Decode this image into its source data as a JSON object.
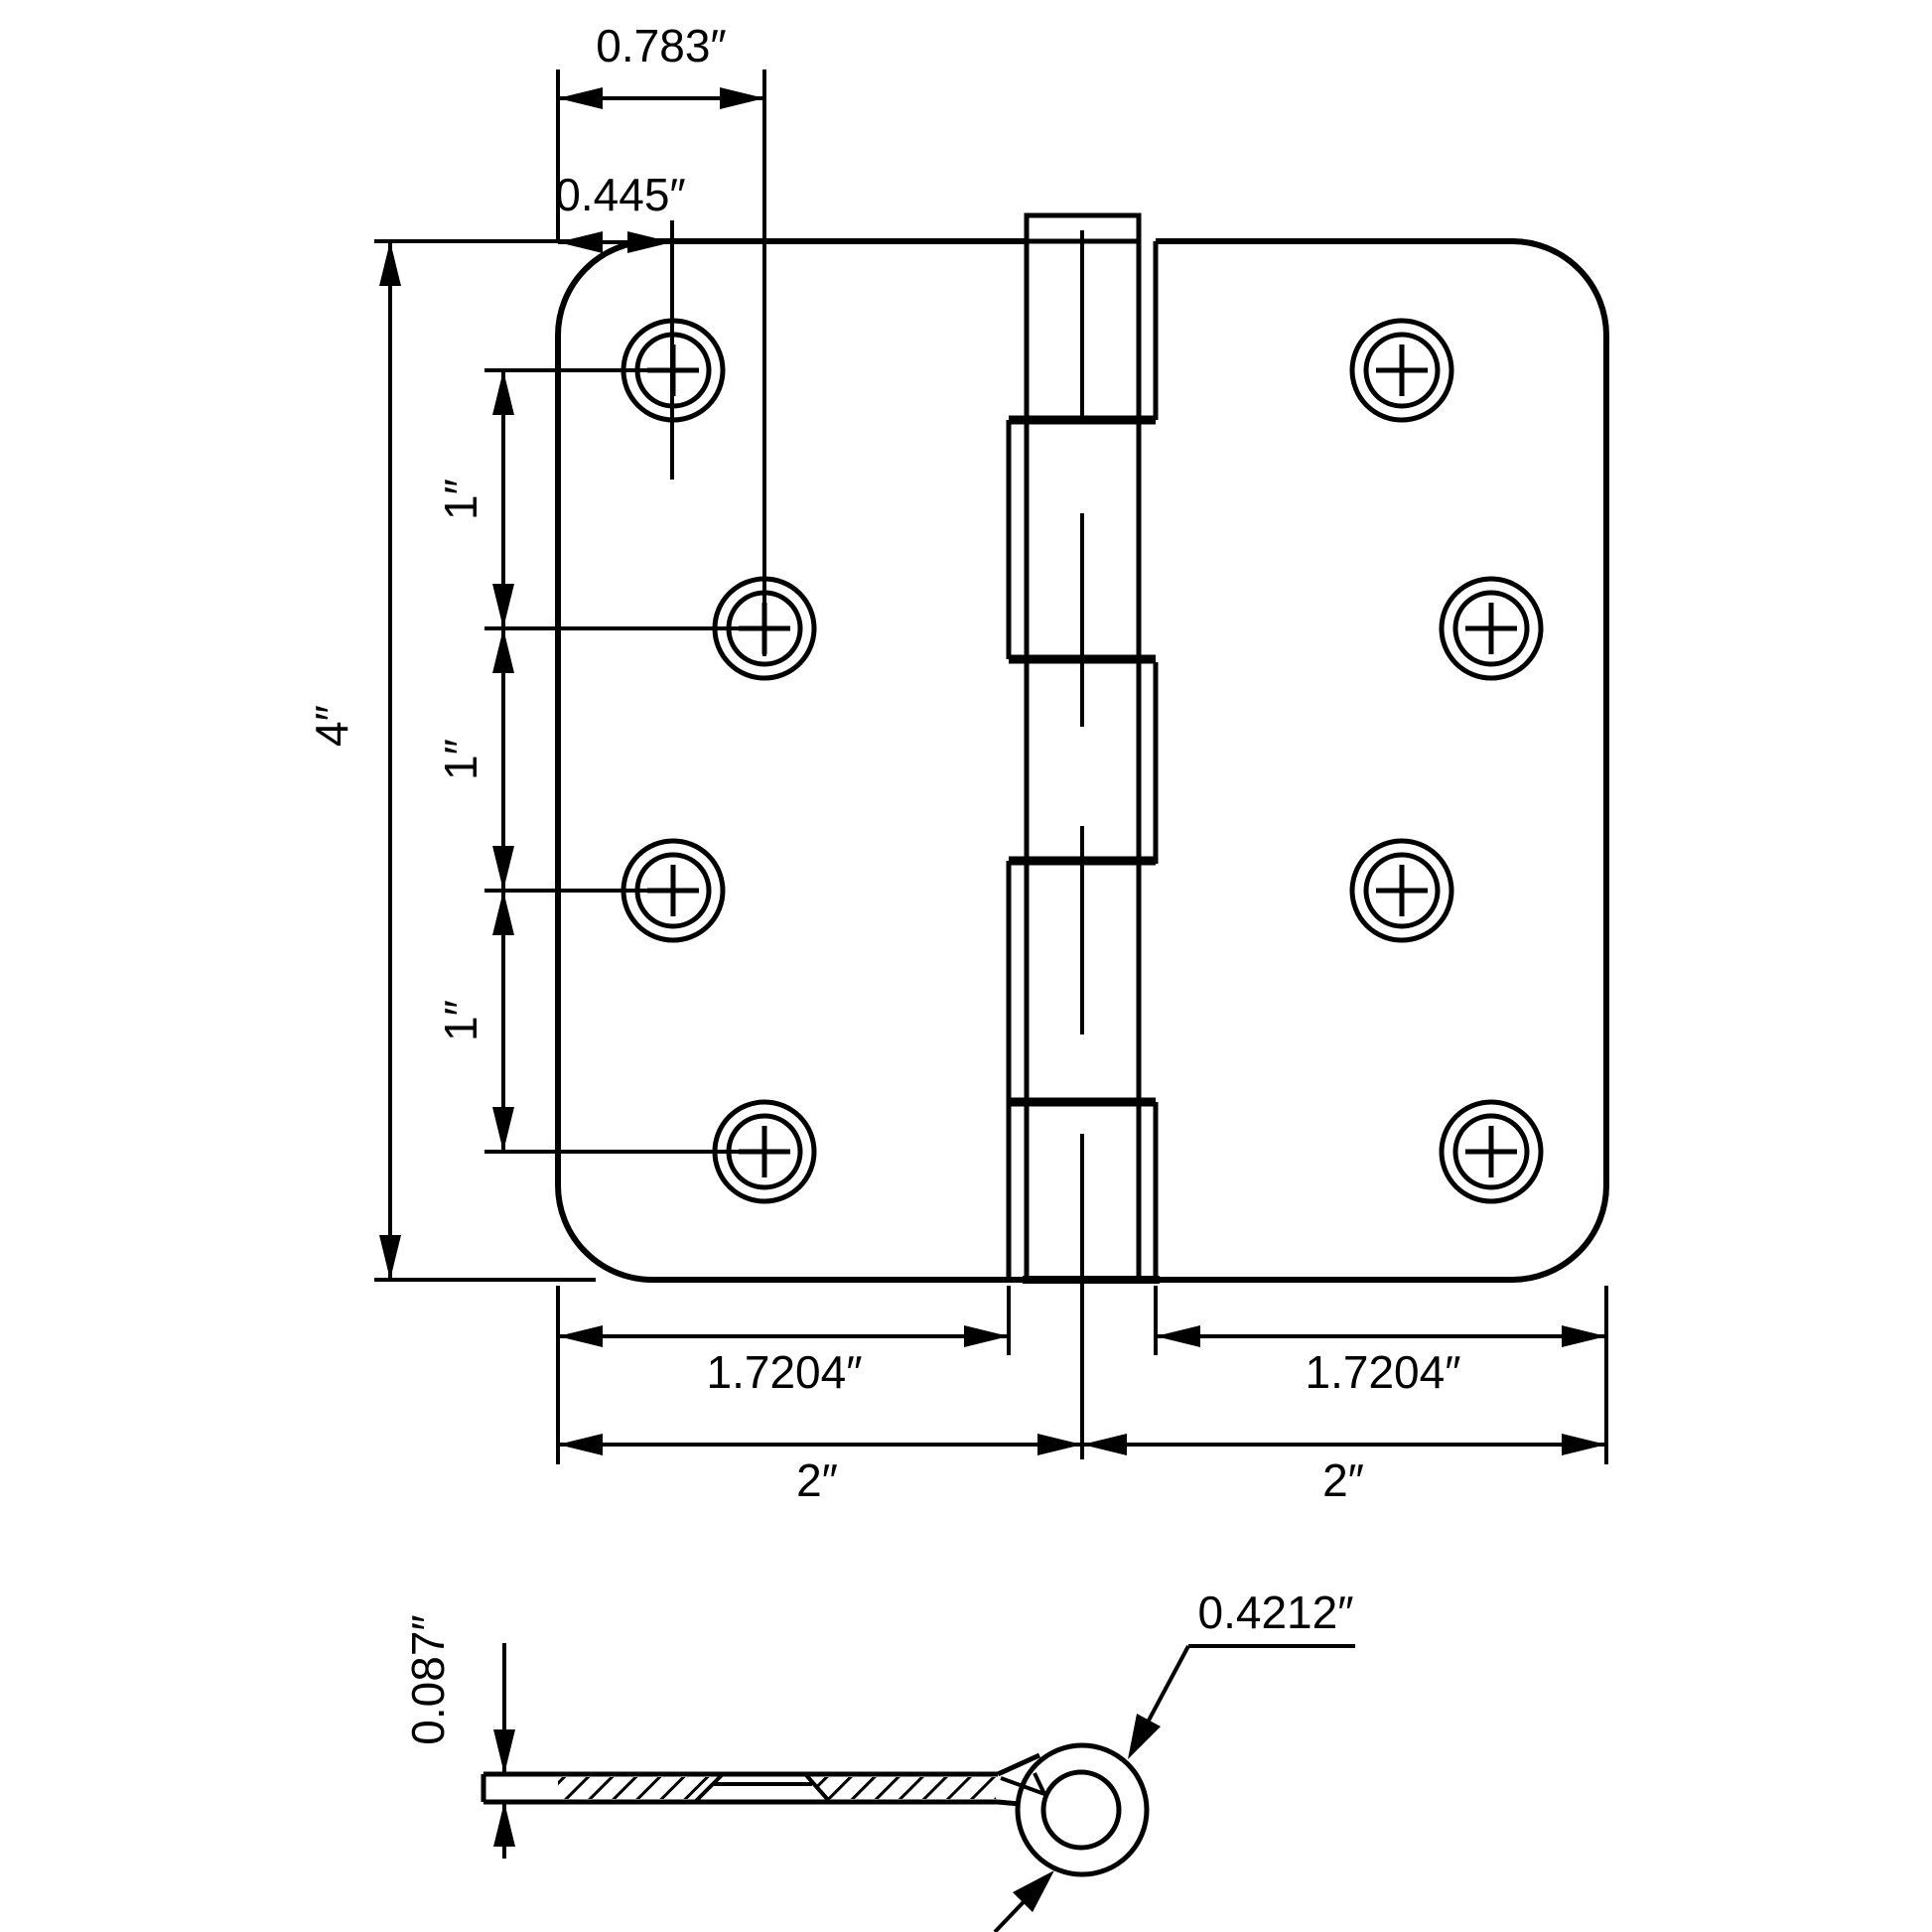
{
  "drawing": {
    "top_view": {
      "dim_edge_to_hole_far": "0.783″",
      "dim_edge_to_hole_near": "0.445″",
      "dim_height": "4″",
      "dim_hole_pitch_top": "1″",
      "dim_hole_pitch_mid": "1″",
      "dim_hole_pitch_bottom": "1″",
      "dim_left_leaf_width": "1.7204″",
      "dim_right_leaf_width": "1.7204″",
      "dim_left_half": "2″",
      "dim_right_half": "2″"
    },
    "side_view": {
      "dim_thickness": "0.087″",
      "dim_knuckle_outer": "0.4212″"
    }
  }
}
